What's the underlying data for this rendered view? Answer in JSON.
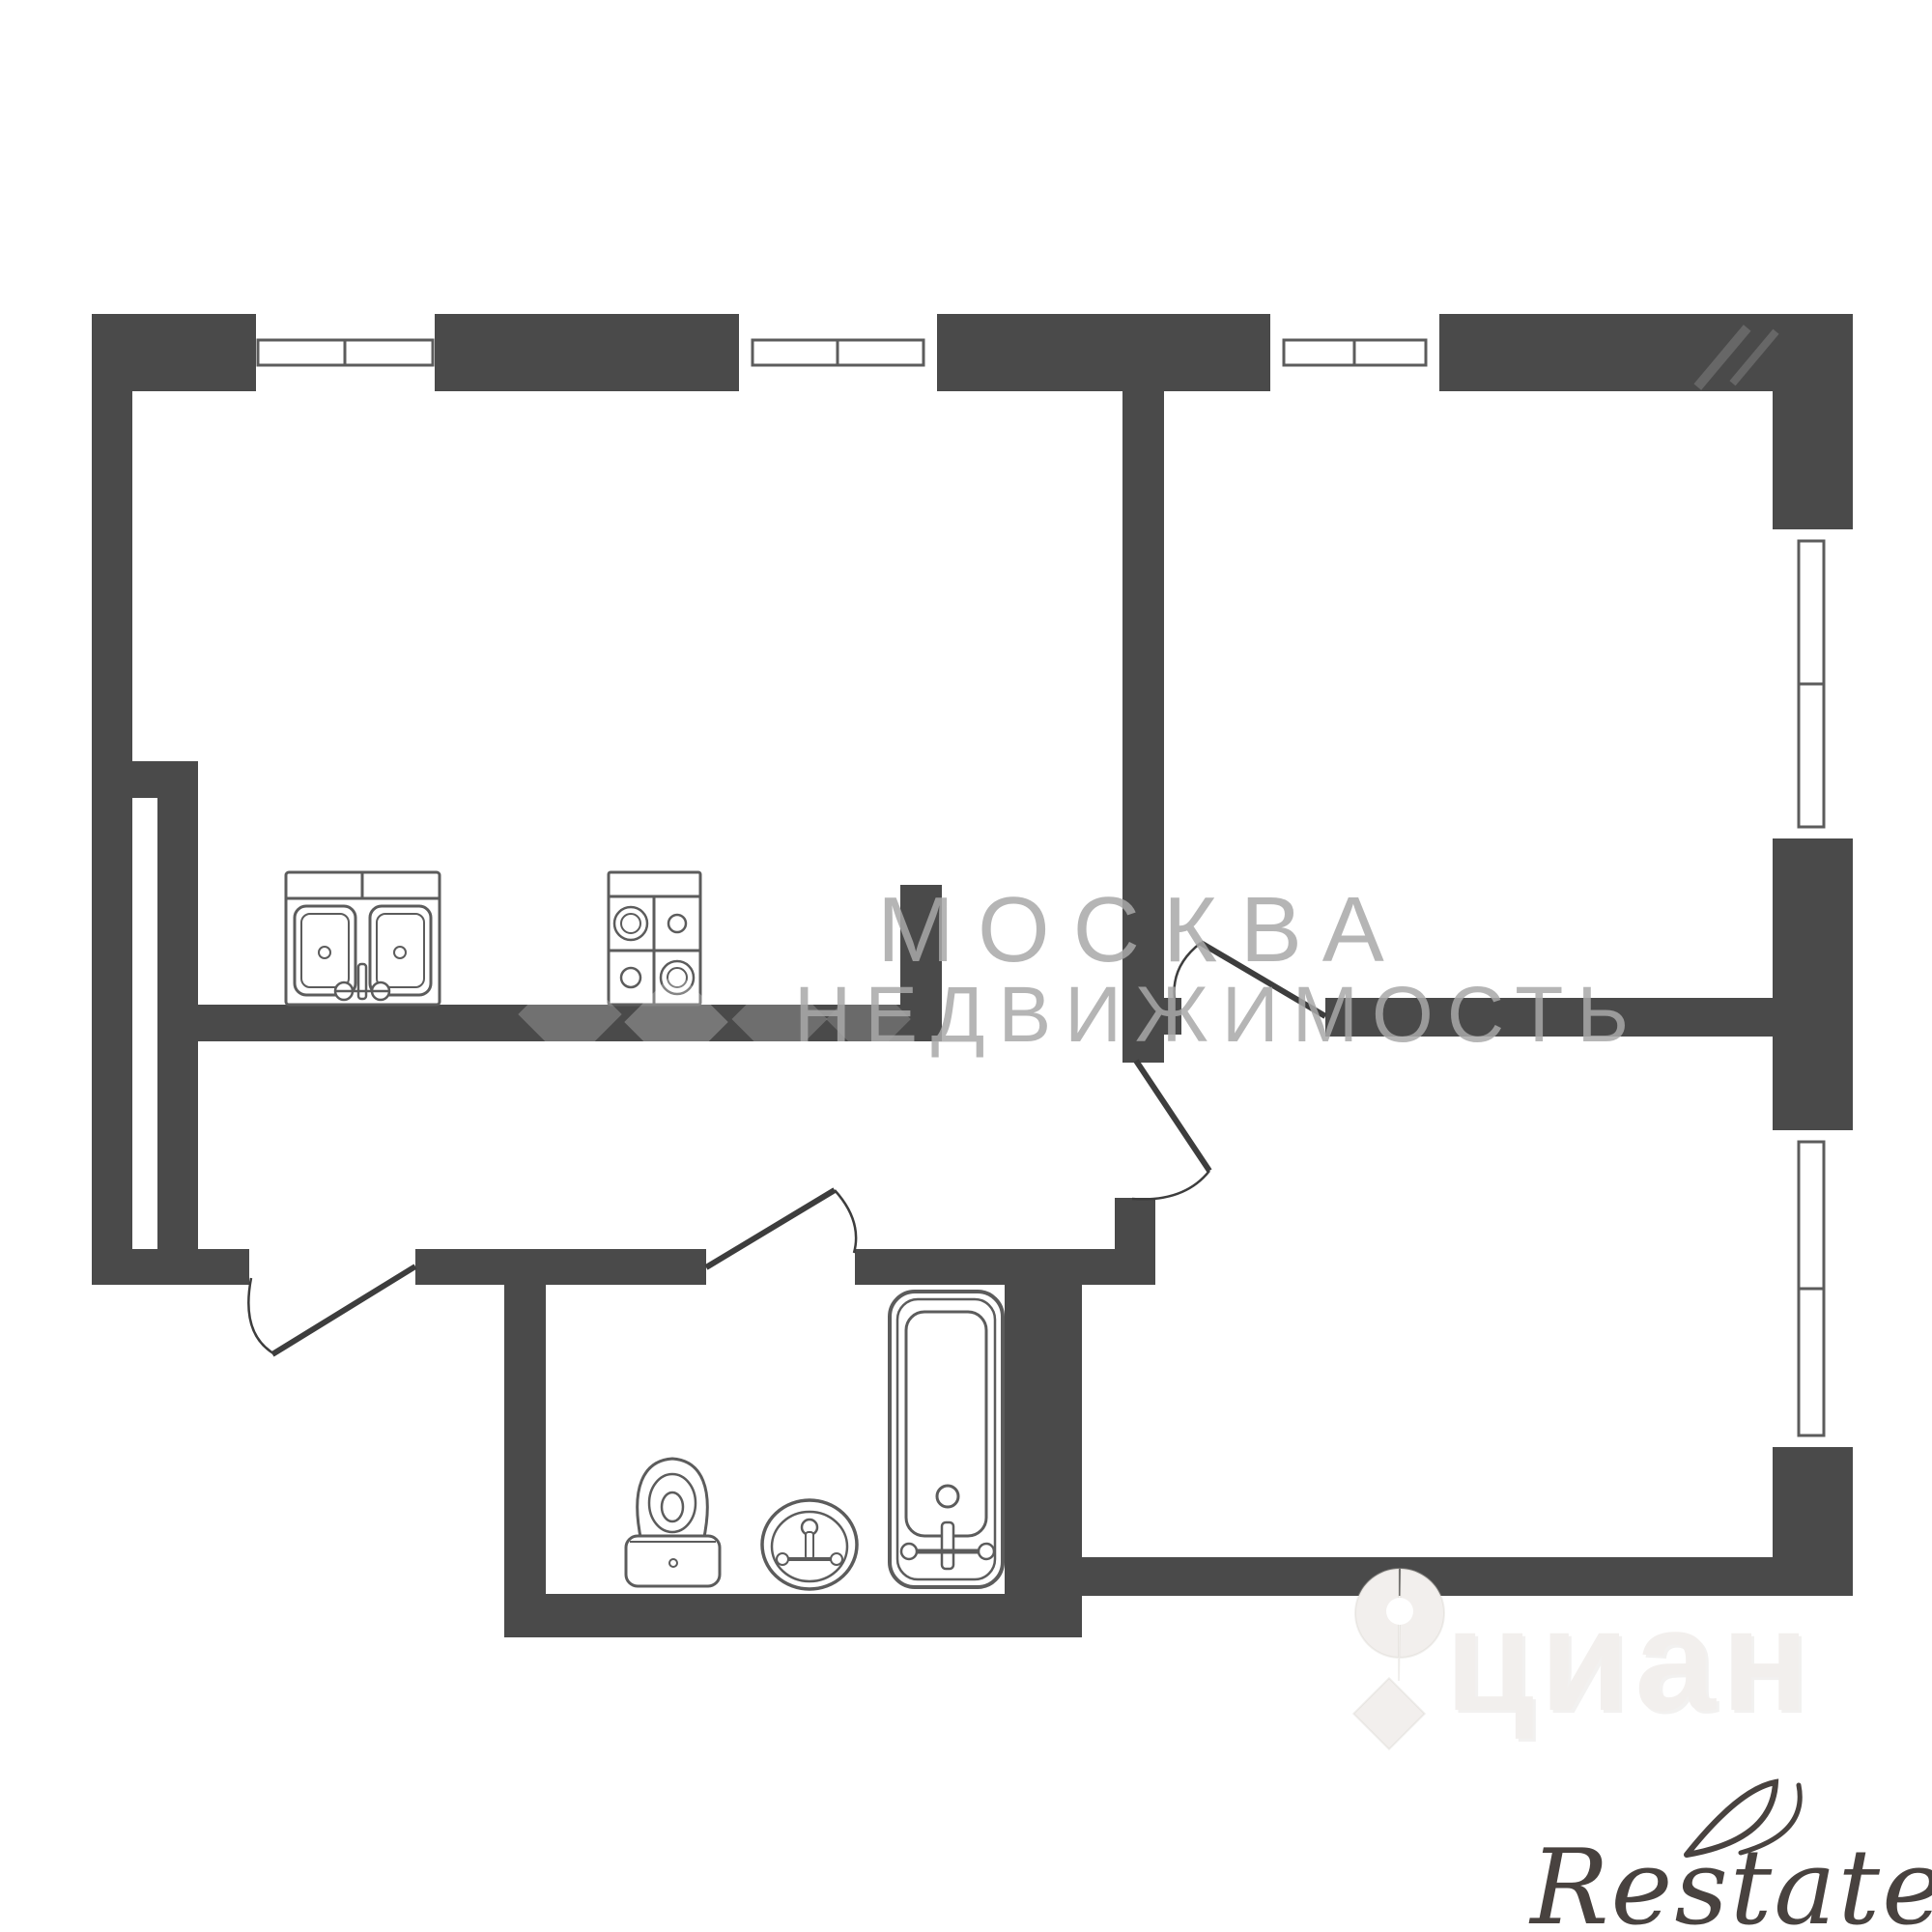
{
  "plan": {
    "type": "apartment-floorplan",
    "style": "2D black-and-white architectural plan",
    "colors": {
      "wall": "#4a4a4a",
      "background": "#ffffff",
      "fixture_stroke": "#5c5c5c",
      "door_stroke": "#3d3d3d",
      "watermark_gray": "#a8a8a8",
      "cian_watermark": "#f2efed",
      "restate_logo": "#48423f"
    },
    "fixtures": [
      "kitchen-double-sink",
      "kitchen-stove-4-burners",
      "toilet",
      "washbasin",
      "bathtub"
    ],
    "openings": {
      "windows_top_wall": 3,
      "windows_right_wall": 2,
      "doors": [
        "entry-door",
        "bathroom-door",
        "room-right-top-door",
        "room-right-bottom-door"
      ]
    }
  },
  "watermarks": {
    "agency_line1": "МОСКВА",
    "agency_line2": "НЕДВИЖИМОСТЬ",
    "portal_logo": "циан",
    "brand_logo": "Restate"
  }
}
